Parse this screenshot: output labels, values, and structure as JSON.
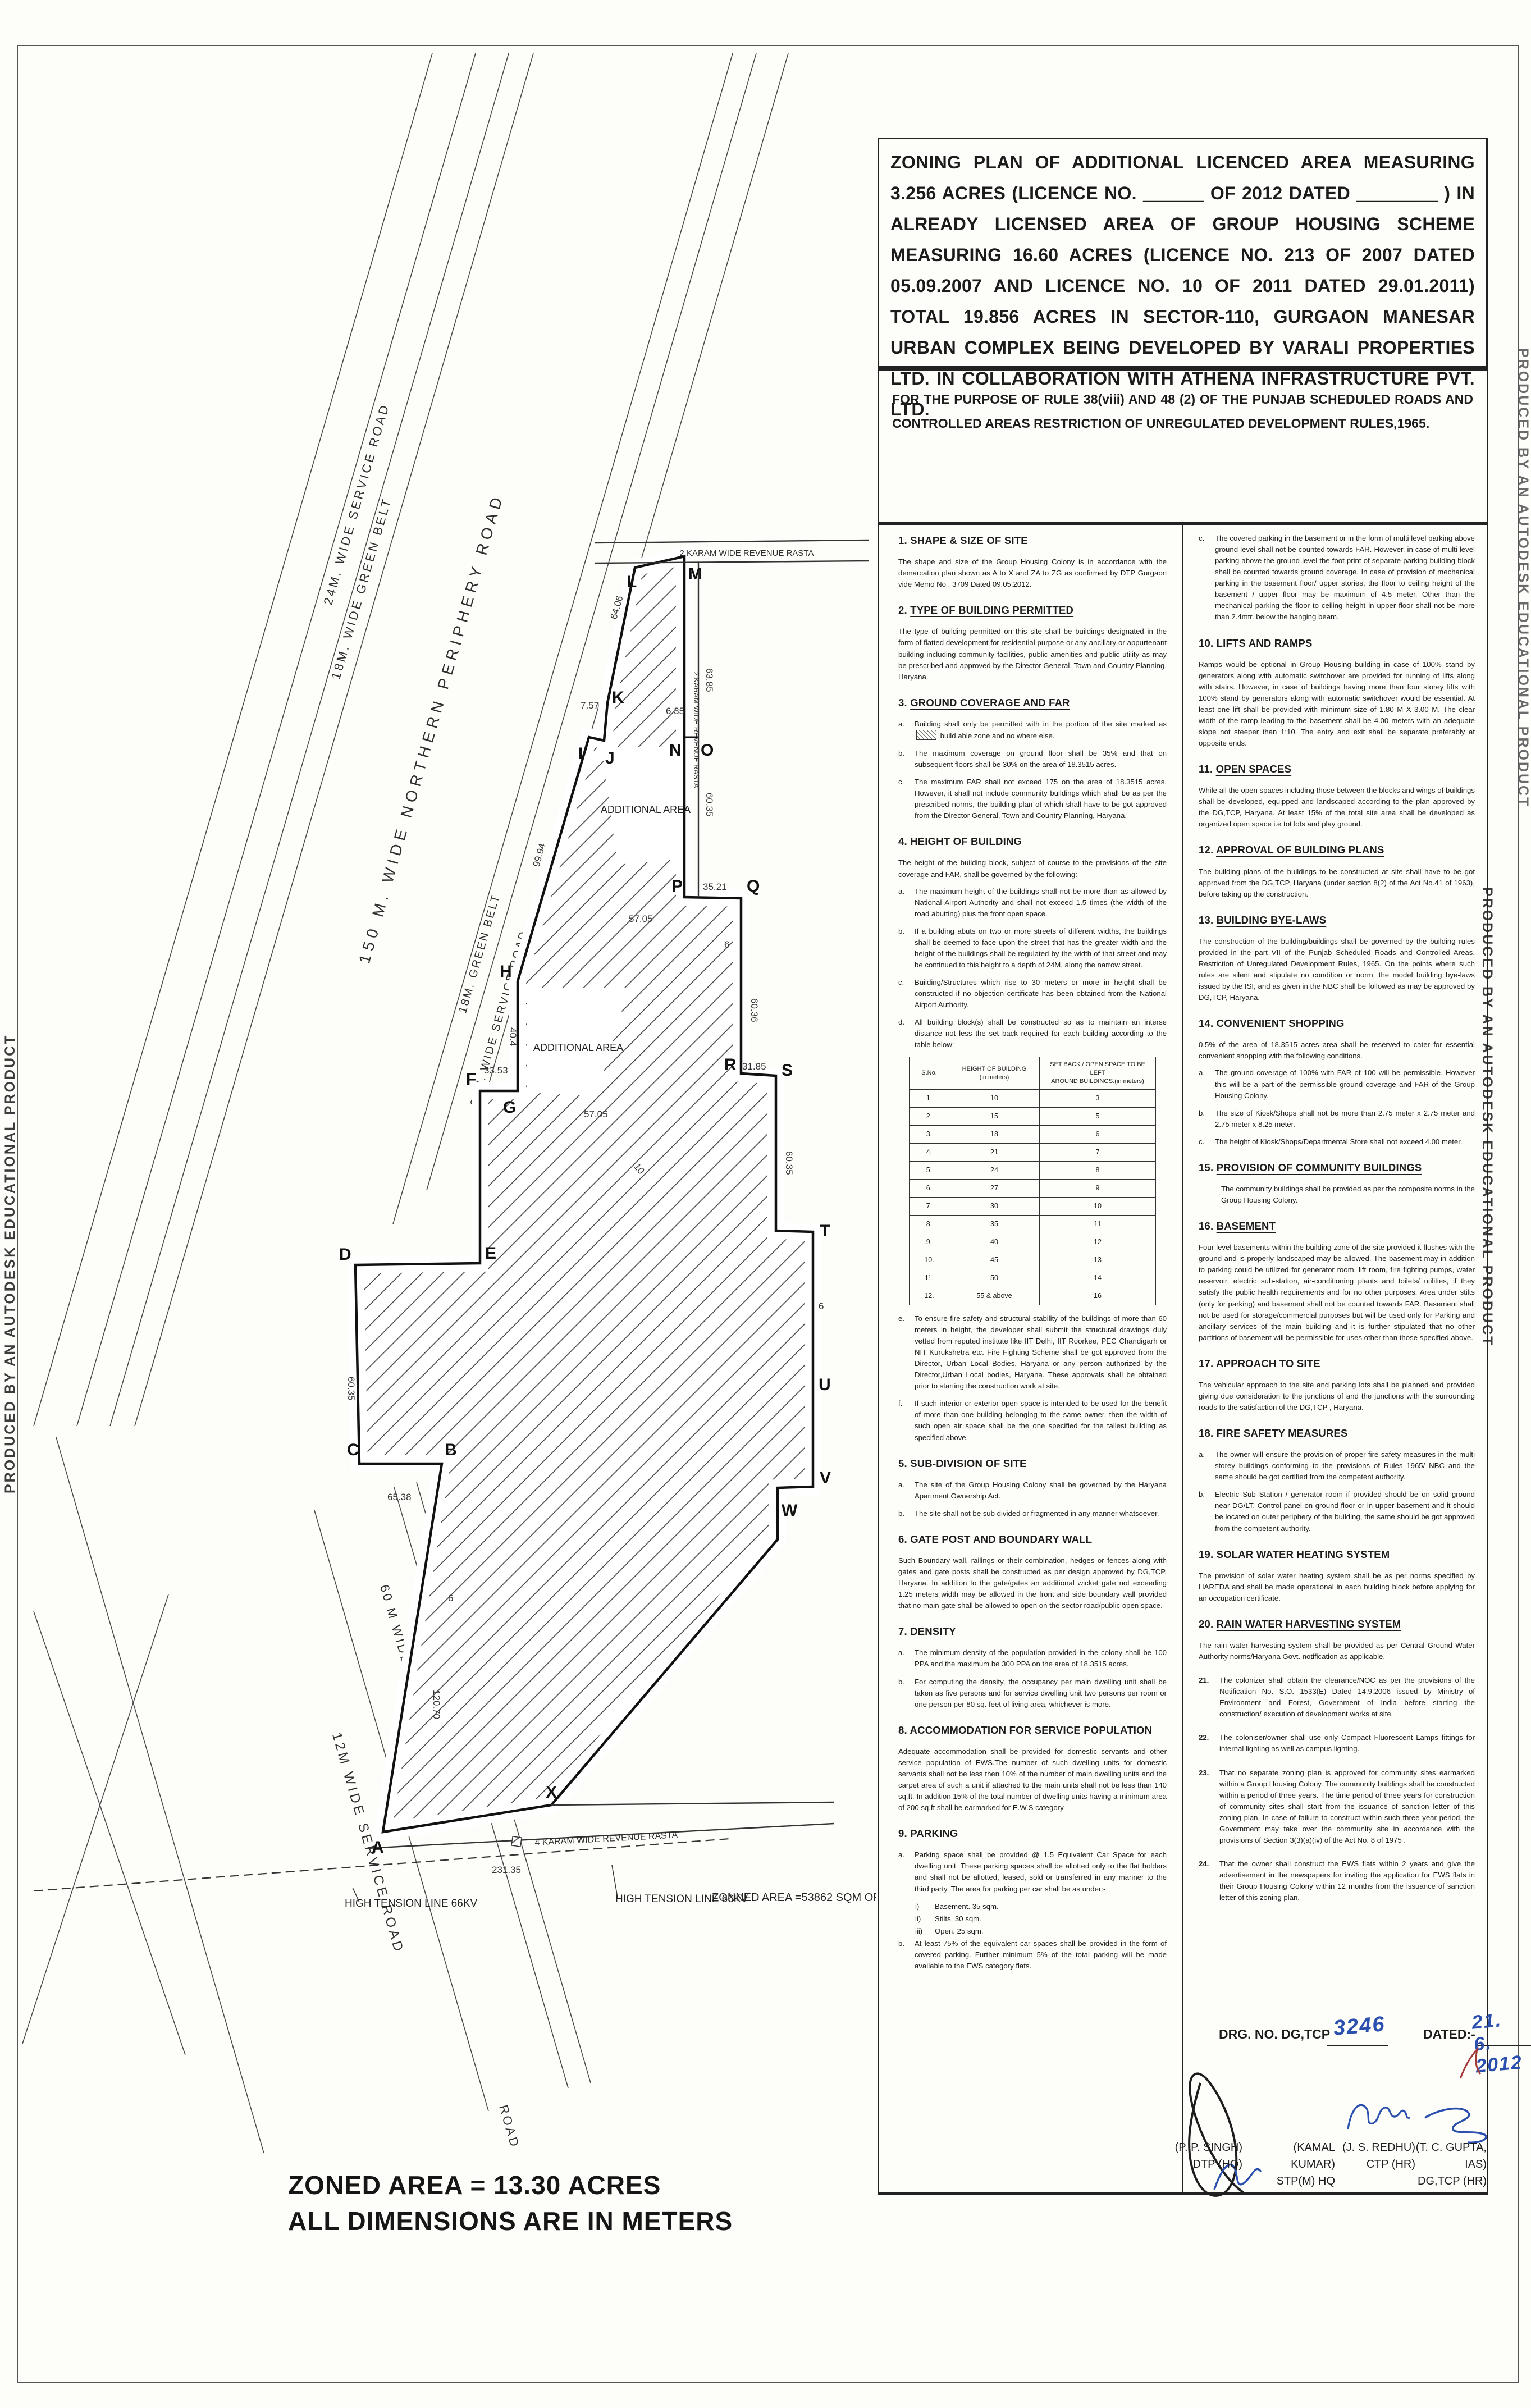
{
  "banner": "PRODUCED BY AN AUTODESK EDUCATIONAL PRODUCT",
  "title_block": {
    "text": "ZONING PLAN OF ADDITIONAL LICENCED AREA MEASURING 3.256 ACRES (LICENCE NO. ______ OF 2012 DATED ________ ) IN ALREADY LICENSED AREA OF GROUP HOUSING SCHEME MEASURING 16.60 ACRES (LICENCE NO. 213 OF 2007 DATED 05.09.2007 AND LICENCE NO. 10 OF 2011 DATED 29.01.2011) TOTAL 19.856 ACRES IN SECTOR-110, GURGAON MANESAR URBAN COMPLEX BEING DEVELOPED BY VARALI PROPERTIES LTD. IN COLLABORATION WITH ATHENA INFRASTRUCTURE PVT. LTD."
  },
  "purpose": "FOR THE PURPOSE OF RULE 38(viii) AND 48 (2) OF THE PUNJAB SCHEDULED ROADS AND CONTROLLED AREAS RESTRICTION OF UNREGULATED DEVELOPMENT RULES,1965.",
  "sections": {
    "s1": {
      "num": "1.",
      "title": "SHAPE & SIZE OF SITE",
      "body": "The shape and size of the Group Housing Colony is in accordance with the demarcation plan shown as A to X and ZA to ZG as confirmed by DTP Gurgaon vide Memo No . 3709 Dated 09.05.2012."
    },
    "s2": {
      "num": "2.",
      "title": "TYPE OF BUILDING PERMITTED",
      "body": "The type of building permitted on this site shall be buildings designated in the form of flatted development for residential purpose or any ancillary or appurtenant building including community facilities, public amenities and public utility as may be prescribed and approved by the Director General, Town and Country Planning, Haryana."
    },
    "s3": {
      "num": "3.",
      "title": "GROUND COVERAGE AND FAR",
      "a_label": "a.",
      "a_text1": "Building shall only be permitted with in the portion of the site marked as",
      "a_text2": "build able zone and no where else.",
      "items": [
        {
          "label": "b.",
          "text": "The maximum coverage on ground floor shall be 35% and that on subsequent floors shall be 30% on the area of 18.3515 acres."
        },
        {
          "label": "c.",
          "text": "The maximum FAR shall not exceed 175 on the area of 18.3515 acres. However, it shall not include community buildings which shall be as per the prescribed norms, the building plan of which shall have to be got approved from the Director General, Town and Country Planning, Haryana."
        }
      ]
    },
    "s4": {
      "num": "4.",
      "title": "HEIGHT OF BUILDING",
      "intro": "The height of the building block, subject of course to the provisions of the site coverage and FAR, shall be governed by the following:-",
      "items": [
        {
          "label": "a.",
          "text": "The maximum height of the buildings shall not be more than as allowed by National Airport Authority and shall not exceed 1.5 times (the width of the road abutting) plus the front open space."
        },
        {
          "label": "b.",
          "text": "If a building abuts on two or more streets of different widths, the buildings shall be deemed to face upon the street that has the greater width and the height of the buildings shall be regulated by the width of that street and may be continued to this height to a depth of 24M, along the narrow street."
        },
        {
          "label": "c.",
          "text": "Building/Structures which rise to 30 meters or more in height shall be constructed if no objection certificate has been obtained from the National Airport Authority."
        },
        {
          "label": "d.",
          "text": "All building block(s) shall be constructed so as to maintain an interse distance not less the set back required for each building according to the table below:-"
        }
      ],
      "post_items": [
        {
          "label": "e.",
          "text": "To ensure fire safety and structural stability of the buildings of more than 60 meters in height, the developer shall submit the structural drawings duly vetted from reputed institute like IIT Delhi, IIT Roorkee, PEC Chandigarh or NIT Kurukshetra etc. Fire Fighting Scheme shall be got approved from the Director, Urban Local Bodies, Haryana or any person authorized by the Director,Urban Local bodies, Haryana. These approvals shall be obtained prior to starting the construction work at site."
        },
        {
          "label": "f.",
          "text": "If such interior or exterior open space is intended to be used for the benefit of more than one building belonging to the same owner, then the width of such open air space shall be the one specified for the tallest building as specified above."
        }
      ]
    },
    "s5": {
      "num": "5.",
      "title": "SUB-DIVISION OF SITE",
      "items": [
        {
          "label": "a.",
          "text": "The site of the Group Housing Colony shall be governed by the Haryana Apartment Ownership Act."
        },
        {
          "label": "b.",
          "text": "The site shall not be sub divided or fragmented in any manner whatsoever."
        }
      ]
    },
    "s6": {
      "num": "6.",
      "title": "GATE POST AND BOUNDARY WALL",
      "body": "Such Boundary wall, railings or their combination, hedges or fences along with gates and gate posts shall be constructed as per design approved by DG,TCP, Haryana. In addition to the gate/gates an additional wicket gate not exceeding 1.25 meters width may be allowed in the front and side boundary wall provided that no main gate shall be allowed to open on the sector road/public open space."
    },
    "s7": {
      "num": "7.",
      "title": "DENSITY",
      "items": [
        {
          "label": "a.",
          "text": "The minimum density of the population provided in the colony shall be 100 PPA and the maximum be 300 PPA on the area of 18.3515 acres."
        },
        {
          "label": "b.",
          "text": "For computing the density, the occupancy per main dwelling unit shall be taken as five persons and for service dwelling unit two persons per room or one person per 80 sq. feet of living area, whichever is more."
        }
      ]
    },
    "s8": {
      "num": "8.",
      "title": "ACCOMMODATION FOR SERVICE POPULATION",
      "body": "Adequate accommodation shall be provided for domestic servants and other service population of EWS.The number of such dwelling units for domestic servants shall not be less then 10% of the number of main dwelling units and the carpet area of such a unit if attached to the main units shall not be less than 140 sq.ft. In addition 15% of the total number of dwelling units having a minimum area of 200 sq.ft shall be earmarked for E.W.S category."
    },
    "s9": {
      "num": "9.",
      "title": "PARKING",
      "a_label": "a.",
      "a_text": "Parking space shall be provided @ 1.5 Equivalent Car Space for each dwelling unit. These parking spaces shall be allotted only to the flat holders and shall not be allotted, leased, sold or transferred in any manner to the third party. The area for parking per car shall be as under:-",
      "roman": [
        {
          "label": "i)",
          "text": "Basement. 35 sqm."
        },
        {
          "label": "ii)",
          "text": "Stilts.      30 sqm."
        },
        {
          "label": "iii)",
          "text": "Open.     25 sqm."
        }
      ],
      "b_label": "b.",
      "b_text": "At least 75% of the equivalent car spaces shall be provided in the form of covered parking. Further minimum 5% of the total parking will be made available to the EWS category flats."
    }
  },
  "height_table": {
    "h1": "S.No.",
    "h2a": "HEIGHT OF BUILDING",
    "h2b": "(in meters)",
    "h3a": "SET BACK / OPEN SPACE TO BE LEFT",
    "h3b": "AROUND BUILDINGS.(in meters)",
    "rows": [
      [
        "1.",
        "10",
        "3"
      ],
      [
        "2.",
        "15",
        "5"
      ],
      [
        "3.",
        "18",
        "6"
      ],
      [
        "4.",
        "21",
        "7"
      ],
      [
        "5.",
        "24",
        "8"
      ],
      [
        "6.",
        "27",
        "9"
      ],
      [
        "7.",
        "30",
        "10"
      ],
      [
        "8.",
        "35",
        "11"
      ],
      [
        "9.",
        "40",
        "12"
      ],
      [
        "10.",
        "45",
        "13"
      ],
      [
        "11.",
        "50",
        "14"
      ],
      [
        "12.",
        "55 & above",
        "16"
      ]
    ]
  },
  "right": {
    "c_label": "c.",
    "c_text": "The covered parking in the basement or in the form of multi level parking above ground level shall not be counted towards FAR. However, in case of multi level parking above the ground level the foot print of separate parking building block shall be counted towards ground coverage. In case of provision of mechanical parking in the basement floor/ upper stories, the floor to ceiling height of the basement / upper floor may be maximum of 4.5 meter. Other than the mechanical parking the floor to ceiling height in upper floor shall not be more than 2.4mtr. below the hanging beam.",
    "s10": {
      "num": "10.",
      "title": "LIFTS AND RAMPS",
      "body": "Ramps would be optional in Group Housing building in case of 100% stand by generators along with automatic switchover are provided for running of lifts along with stairs.  However, in case of buildings having more than four storey lifts with 100% stand by generators along with automatic switchover would be essential. At least one lift shall be provided with minimum size of 1.80 M X 3.00 M. The clear width of the ramp leading to the basement shall be 4.00 meters with an adequate slope not steeper than 1:10. The entry and exit shall be separate preferably at opposite ends."
    },
    "s11": {
      "num": "11.",
      "title": "OPEN SPACES",
      "body": "While all the open spaces including those between the blocks and wings of buildings shall be developed, equipped and landscaped  according to the plan approved by the DG,TCP, Haryana. At least 15% of the total site area shall be developed as organized open space i.e tot lots and play ground."
    },
    "s12": {
      "num": "12.",
      "title": "APPROVAL OF BUILDING PLANS",
      "body": "The building plans of the buildings to be constructed at site shall have to be got approved from the DG,TCP, Haryana (under section 8(2) of the Act No.41 of 1963), before taking  up the construction."
    },
    "s13": {
      "num": "13.",
      "title": "BUILDING BYE-LAWS",
      "body": "The construction of the building/buildings shall be governed by the building rules  provided in the part VII of the Punjab Scheduled Roads and Controlled Areas, Restriction of Unregulated Development Rules, 1965. On the points where such rules  are silent and stipulate no condition or norm, the model building bye-laws issued by the ISI, and as given in the NBC shall be followed as may be approved by DG,TCP, Haryana.",
      "s14num": "14.",
      "s14title": "CONVENIENT SHOPPING"
    },
    "s14_intro": "0.5% of the area of 18.3515  acres area shall be reserved to cater for essential convenient shopping with the following conditions.",
    "s14_items": [
      {
        "label": "a.",
        "text": "The ground coverage of 100% with FAR of 100 will be permissible. However this will be a part of the permissible ground coverage and FAR of the Group Housing Colony."
      },
      {
        "label": "b.",
        "text": "The size of Kiosk/Shops shall not be more than 2.75 meter x 2.75 meter and 2.75 meter x 8.25 meter."
      },
      {
        "label": "c.",
        "text": "The height of Kiosk/Shops/Departmental Store shall not exceed 4.00 meter."
      }
    ],
    "s15": {
      "num": "15.",
      "title": "PROVISION OF COMMUNITY BUILDINGS",
      "body": "The community buildings shall be provided as per the composite norms in the Group  Housing Colony."
    },
    "s16": {
      "num": "16.",
      "title": "BASEMENT",
      "body": "Four level basements within the building zone of the site provided it flushes with the  ground and is properly landscaped may be allowed. The basement may in addition to parking could be utilized for generator room, lift room, fire fighting pumps, water reservoir, electric sub-station, air-conditioning plants and toilets/ utilities, if they satisfy the public health requirements and for no other purposes. Area under stilts (only for parking) and basement shall not be counted towards FAR. Basement shall not be used for storage/commercial purposes but will be used only for Parking and ancillary services of the main building and it is further stipulated that no other partitions of basement will be permissible  for uses other than those specified above."
    },
    "s17": {
      "num": "17.",
      "title": "APPROACH TO SITE",
      "body": "The vehicular approach to the site and parking lots shall be planned and provided giving due consideration to the junctions of and the junctions with the surrounding roads to the satisfaction of the DG,TCP , Haryana."
    },
    "s18": {
      "num": "18.",
      "title": "FIRE SAFETY MEASURES",
      "items": [
        {
          "label": "a.",
          "text": "The owner will ensure the provision of proper fire safety measures in the multi storey buildings conforming to the provisions of Rules 1965/ NBC and the same should be got certified from the competent authority."
        },
        {
          "label": "b.",
          "text": "Electric Sub Station / generator room if provided should be on solid ground near  DG/LT. Control panel on ground floor or in upper basement and it should be located on outer periphery of the building, the same should be got approved from the competent authority."
        }
      ]
    },
    "s19": {
      "num": "19.",
      "title": "SOLAR WATER HEATING SYSTEM",
      "body": "The provision of solar water heating system shall be as per norms specified by HAREDA and shall be made operational in each building block before applying for an occupation certificate."
    },
    "s20": {
      "num": "20.",
      "title": "RAIN WATER HARVESTING SYSTEM",
      "body": "The rain water harvesting system shall be provided as per Central Ground Water Authority norms/Haryana Govt. notification as applicable."
    },
    "n21": {
      "label": "21.",
      "text": "The colonizer shall obtain the clearance/NOC as per the provisions of the Notification No. S.O. 1533(E) Dated 14.9.2006 issued by Ministry of Environment and Forest, Government of India before starting the construction/ execution of development  works at site."
    },
    "n22": {
      "label": "22.",
      "text": "The coloniser/owner shall use only Compact Fluorescent Lamps fittings for internal lighting as  well as campus lighting."
    },
    "n23": {
      "label": "23.",
      "text": "That no separate zoning plan is approved for community sites earmarked within a Group Housing Colony. The community buildings shall be constructed within a period of three years. The time period of three years for construction of community sites shall start from the issuance of sanction letter of this zoning plan. In case of failure to construct within such three year period, the Government may take over the community site in accordance with the provisions of Section 3(3)(a)(iv) of the Act No. 8 of 1975 ."
    },
    "n24": {
      "label": "24.",
      "text": "That the owner shall construct the EWS flats within 2 years and give the advertisement in the newspapers for inviting the application for EWS flats in their Group Housing Colony within 12 months from the issuance of sanction letter of this zoning plan."
    }
  },
  "drg": {
    "label": "DRG. NO. DG,TCP",
    "number": "3246",
    "dated_label": "DATED:-",
    "date": "21. 6. 2012"
  },
  "signatories": {
    "s1n": "(P. P. SINGH)",
    "s1t": "DTP (HQ)",
    "s2n": "(KAMAL KUMAR)",
    "s2t": "STP(M) HQ",
    "s3n": "(J. S. REDHU)",
    "s3t": "CTP (HR)",
    "s4n": "(T. C. GUPTA, IAS)",
    "s4t": "DG,TCP (HR)"
  },
  "plan": {
    "roads": {
      "service24_tl": "24M. WIDE SERVICE ROAD",
      "green18_tl": "18M. WIDE GREEN BELT",
      "periphery": "150 M. WIDE NORTHERN PERIPHERY ROAD",
      "green18_b": "18M. GREEN BELT",
      "service24_b": "24M. WIDE SERVICE ROAD",
      "sector60": "60 M WIDE SECTOR ROAD",
      "service12": "12M WIDE SERVICE ROAD",
      "road": "ROAD",
      "rasta_top": "2 KARAM WIDE REVENUE RASTA",
      "rasta_side": "2 KARAM WIDE REVENUE RASTA",
      "rasta_bottom": "4 KARAM WIDE REVENUE RASTA"
    },
    "vertices": {
      "A": "A",
      "B": "B",
      "C": "C",
      "D": "D",
      "E": "E",
      "F": "F",
      "G": "G",
      "H": "H",
      "I": "I",
      "J": "J",
      "K": "K",
      "L": "L",
      "M": "M",
      "N": "N",
      "O": "O",
      "P": "P",
      "Q": "Q",
      "R": "R",
      "S": "S",
      "T": "T",
      "U": "U",
      "V": "V",
      "W": "W",
      "X": "X"
    },
    "dims": [
      "64.06",
      "99.94",
      "7.57",
      "63.85",
      "60.35",
      "6.35",
      "35.21",
      "57.05",
      "60.36",
      "57.05",
      "33.53",
      "40.4",
      "31.85",
      "60.35",
      "60.35",
      "65.38",
      "120.70",
      "231.35",
      "6",
      "6",
      "6",
      "10"
    ],
    "notes": {
      "additional": "ADDITIONAL AREA",
      "ht": "HIGH TENSION LINE 66KV",
      "zonned": "ZONNED AREA =53862 SQM OR 13.309 ACRES",
      "zoned_big": "ZONED AREA = 13.30 ACRES",
      "dims_big": "ALL DIMENSIONS ARE IN METERS"
    }
  }
}
